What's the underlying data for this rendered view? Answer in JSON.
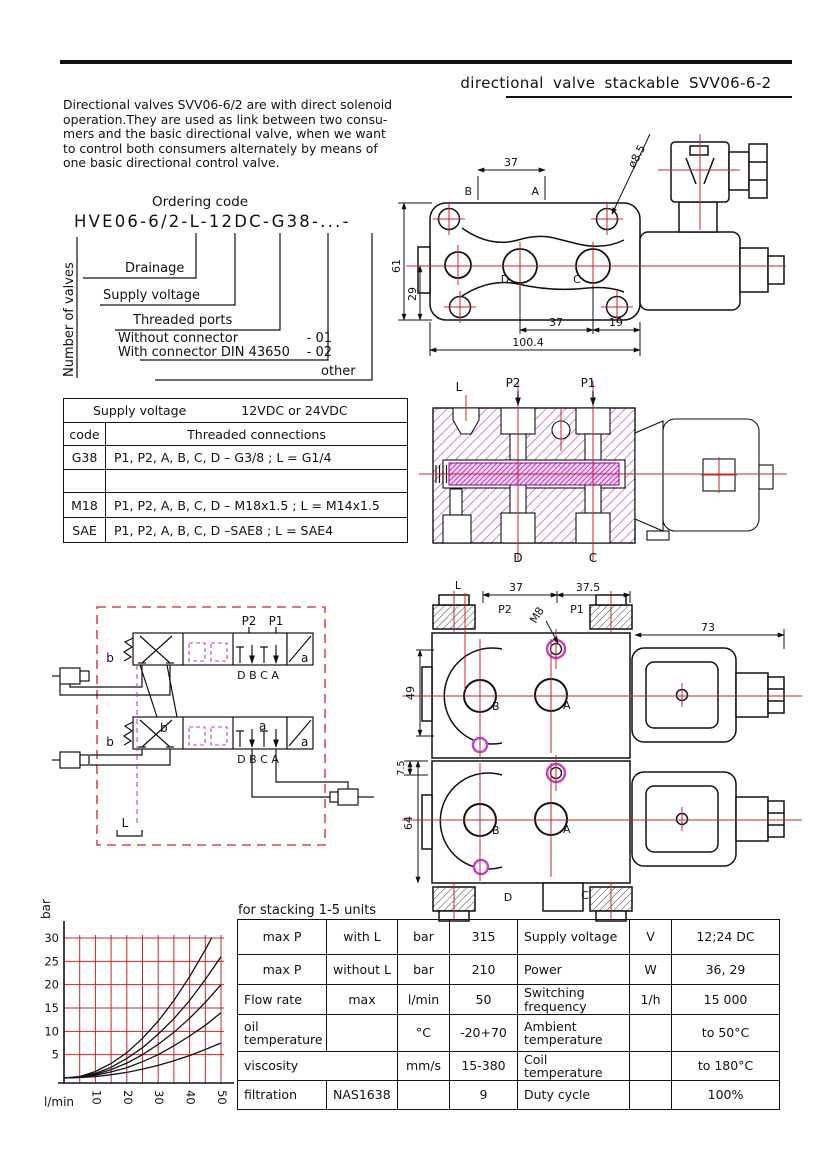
{
  "page": {
    "title": "directional valve stackable SVV06-6-2"
  },
  "intro": {
    "lines": [
      "Directional valves SVV06-6/2 are with direct solenoid",
      "operation.They are used as link between two consu-",
      "mers and the basic directional valve, when we want",
      "to control both consumers alternately by means of",
      "one basic directional control valve."
    ]
  },
  "ordering": {
    "heading": "Ordering code",
    "code": "HVE06-6/2-L-12DC-G38-...-",
    "number_of_valves": "Number of valves",
    "drainage": "Drainage",
    "supply_voltage": "Supply voltage",
    "threaded_ports": "Threaded ports",
    "without_connector": "Without connector",
    "without_code": "- 01",
    "with_connector": "With connector DIN 43650",
    "with_code": "- 02",
    "other": "other"
  },
  "threads_table": {
    "supply_label": "Supply voltage",
    "supply_value": "12VDC or 24VDC",
    "code_header": "code",
    "conn_header": "Threaded connections",
    "rows": [
      {
        "code": "G38",
        "conn": "P1, P2, A, B, C, D – G3/8 ; L = G1/4"
      },
      {
        "code": "",
        "conn": ""
      },
      {
        "code": "M18",
        "conn": "P1, P2, A, B, C, D – M18x1.5 ; L = M14x1.5"
      },
      {
        "code": "SAE",
        "conn": "P1, P2, A, B, C, D –SAE8 ; L = SAE4"
      }
    ]
  },
  "drawing_top": {
    "labels": {
      "b": "B",
      "a": "A",
      "d": "D",
      "c": "C"
    },
    "dims": {
      "top37": "37",
      "dia": "ø8.5",
      "h61": "61",
      "h29": "29",
      "bot37": "37",
      "bot19": "19",
      "total": "100.4"
    }
  },
  "drawing_section": {
    "labels": {
      "l": "L",
      "p2": "P2",
      "p1": "P1",
      "d": "D",
      "c": "C"
    }
  },
  "drawing_front": {
    "labels": {
      "l": "L",
      "p2": "P2",
      "p1": "P1",
      "m8": "M8",
      "b1": "B",
      "a1": "A",
      "b2": "B",
      "a2": "A",
      "d": "D",
      "c": "C"
    },
    "dims": {
      "w37": "37",
      "w375": "37.5",
      "w73": "73",
      "h49": "49",
      "h75": "7.5",
      "h64": "64"
    }
  },
  "schematic": {
    "labels": {
      "p2": "P2",
      "p1": "P1",
      "ports1": "D B C A",
      "ports2": "D B C A",
      "b1": "b",
      "a1": "a",
      "b2": "b",
      "a2": "a",
      "b2i": "b",
      "a2i": "a",
      "l": "L"
    }
  },
  "chart": {
    "ylabel": "bar",
    "xlabel": "l/min",
    "yticks": [
      5,
      10,
      15,
      20,
      25,
      30
    ],
    "xticks": [
      10,
      20,
      30,
      40,
      50
    ]
  },
  "chart_data": {
    "type": "line",
    "title": "",
    "xlabel": "l/min",
    "ylabel": "bar",
    "xlim": [
      0,
      50
    ],
    "ylim": [
      0,
      30
    ],
    "grid": true,
    "grid_color": "#c3272b",
    "series": [
      {
        "name": "curve 1",
        "x": [
          0,
          5,
          10,
          15,
          20,
          25,
          30,
          35,
          40,
          45,
          47
        ],
        "y": [
          0,
          0.3,
          1.4,
          3.1,
          5.4,
          8.5,
          12.2,
          16.6,
          21.7,
          27.5,
          30
        ]
      },
      {
        "name": "curve 2",
        "x": [
          0,
          5,
          10,
          15,
          20,
          25,
          30,
          35,
          40,
          45,
          50
        ],
        "y": [
          0,
          0.3,
          1.0,
          2.3,
          4.2,
          6.5,
          9.4,
          12.7,
          16.6,
          21.1,
          26
        ]
      },
      {
        "name": "curve 3",
        "x": [
          0,
          5,
          10,
          15,
          20,
          25,
          30,
          35,
          40,
          45,
          50
        ],
        "y": [
          0,
          0.2,
          0.8,
          1.8,
          3.2,
          5.0,
          7.2,
          9.8,
          12.8,
          16.2,
          20
        ]
      },
      {
        "name": "curve 4",
        "x": [
          0,
          5,
          10,
          15,
          20,
          25,
          30,
          35,
          40,
          45,
          50
        ],
        "y": [
          0,
          0.1,
          0.6,
          1.3,
          2.2,
          3.5,
          5.0,
          6.9,
          9.0,
          11.3,
          14
        ]
      },
      {
        "name": "curve 5",
        "x": [
          0,
          5,
          10,
          15,
          20,
          25,
          30,
          35,
          40,
          45,
          50
        ],
        "y": [
          0,
          0.1,
          0.3,
          0.7,
          1.2,
          1.9,
          2.7,
          3.7,
          4.8,
          6.1,
          7.5
        ]
      }
    ]
  },
  "specs": {
    "caption": "for stacking 1-5 units",
    "left_rows": [
      {
        "c1": "max P",
        "c2": "with L",
        "c3": "bar",
        "c4": "315"
      },
      {
        "c1": "max P",
        "c2": "without L",
        "c3": "bar",
        "c4": "210"
      },
      {
        "c1": "Flow rate",
        "c2": "max",
        "c3": "l/min",
        "c4": "50"
      },
      {
        "c1": "oil temperature",
        "c2": "",
        "c3": "°C",
        "c4": "-20+70"
      },
      {
        "c1": "viscosity",
        "c2": "",
        "c3": "mm/s",
        "c4": "15-380"
      },
      {
        "c1": "filtration",
        "c2": "NAS1638",
        "c3": "",
        "c4": "9"
      }
    ],
    "right_rows": [
      {
        "label": "Supply voltage",
        "unit": "V",
        "value": "12;24 DC"
      },
      {
        "label": "Power",
        "unit": "W",
        "value": "36, 29"
      },
      {
        "label": "Switching frequency",
        "unit": "1/h",
        "value": "15 000"
      },
      {
        "label": "Ambient temperature",
        "unit": "",
        "value": "to 50°C"
      },
      {
        "label": "Coil temperature",
        "unit": "",
        "value": "to 180°C"
      },
      {
        "label": "Duty cycle",
        "unit": "",
        "value": "100%"
      }
    ]
  },
  "colors": {
    "red": "#c3272b",
    "magenta_hatch": "#c55ec5",
    "magenta_dense": "#cb2fcb",
    "schematic_dash": "#c83ac8",
    "ink": "#111111"
  }
}
